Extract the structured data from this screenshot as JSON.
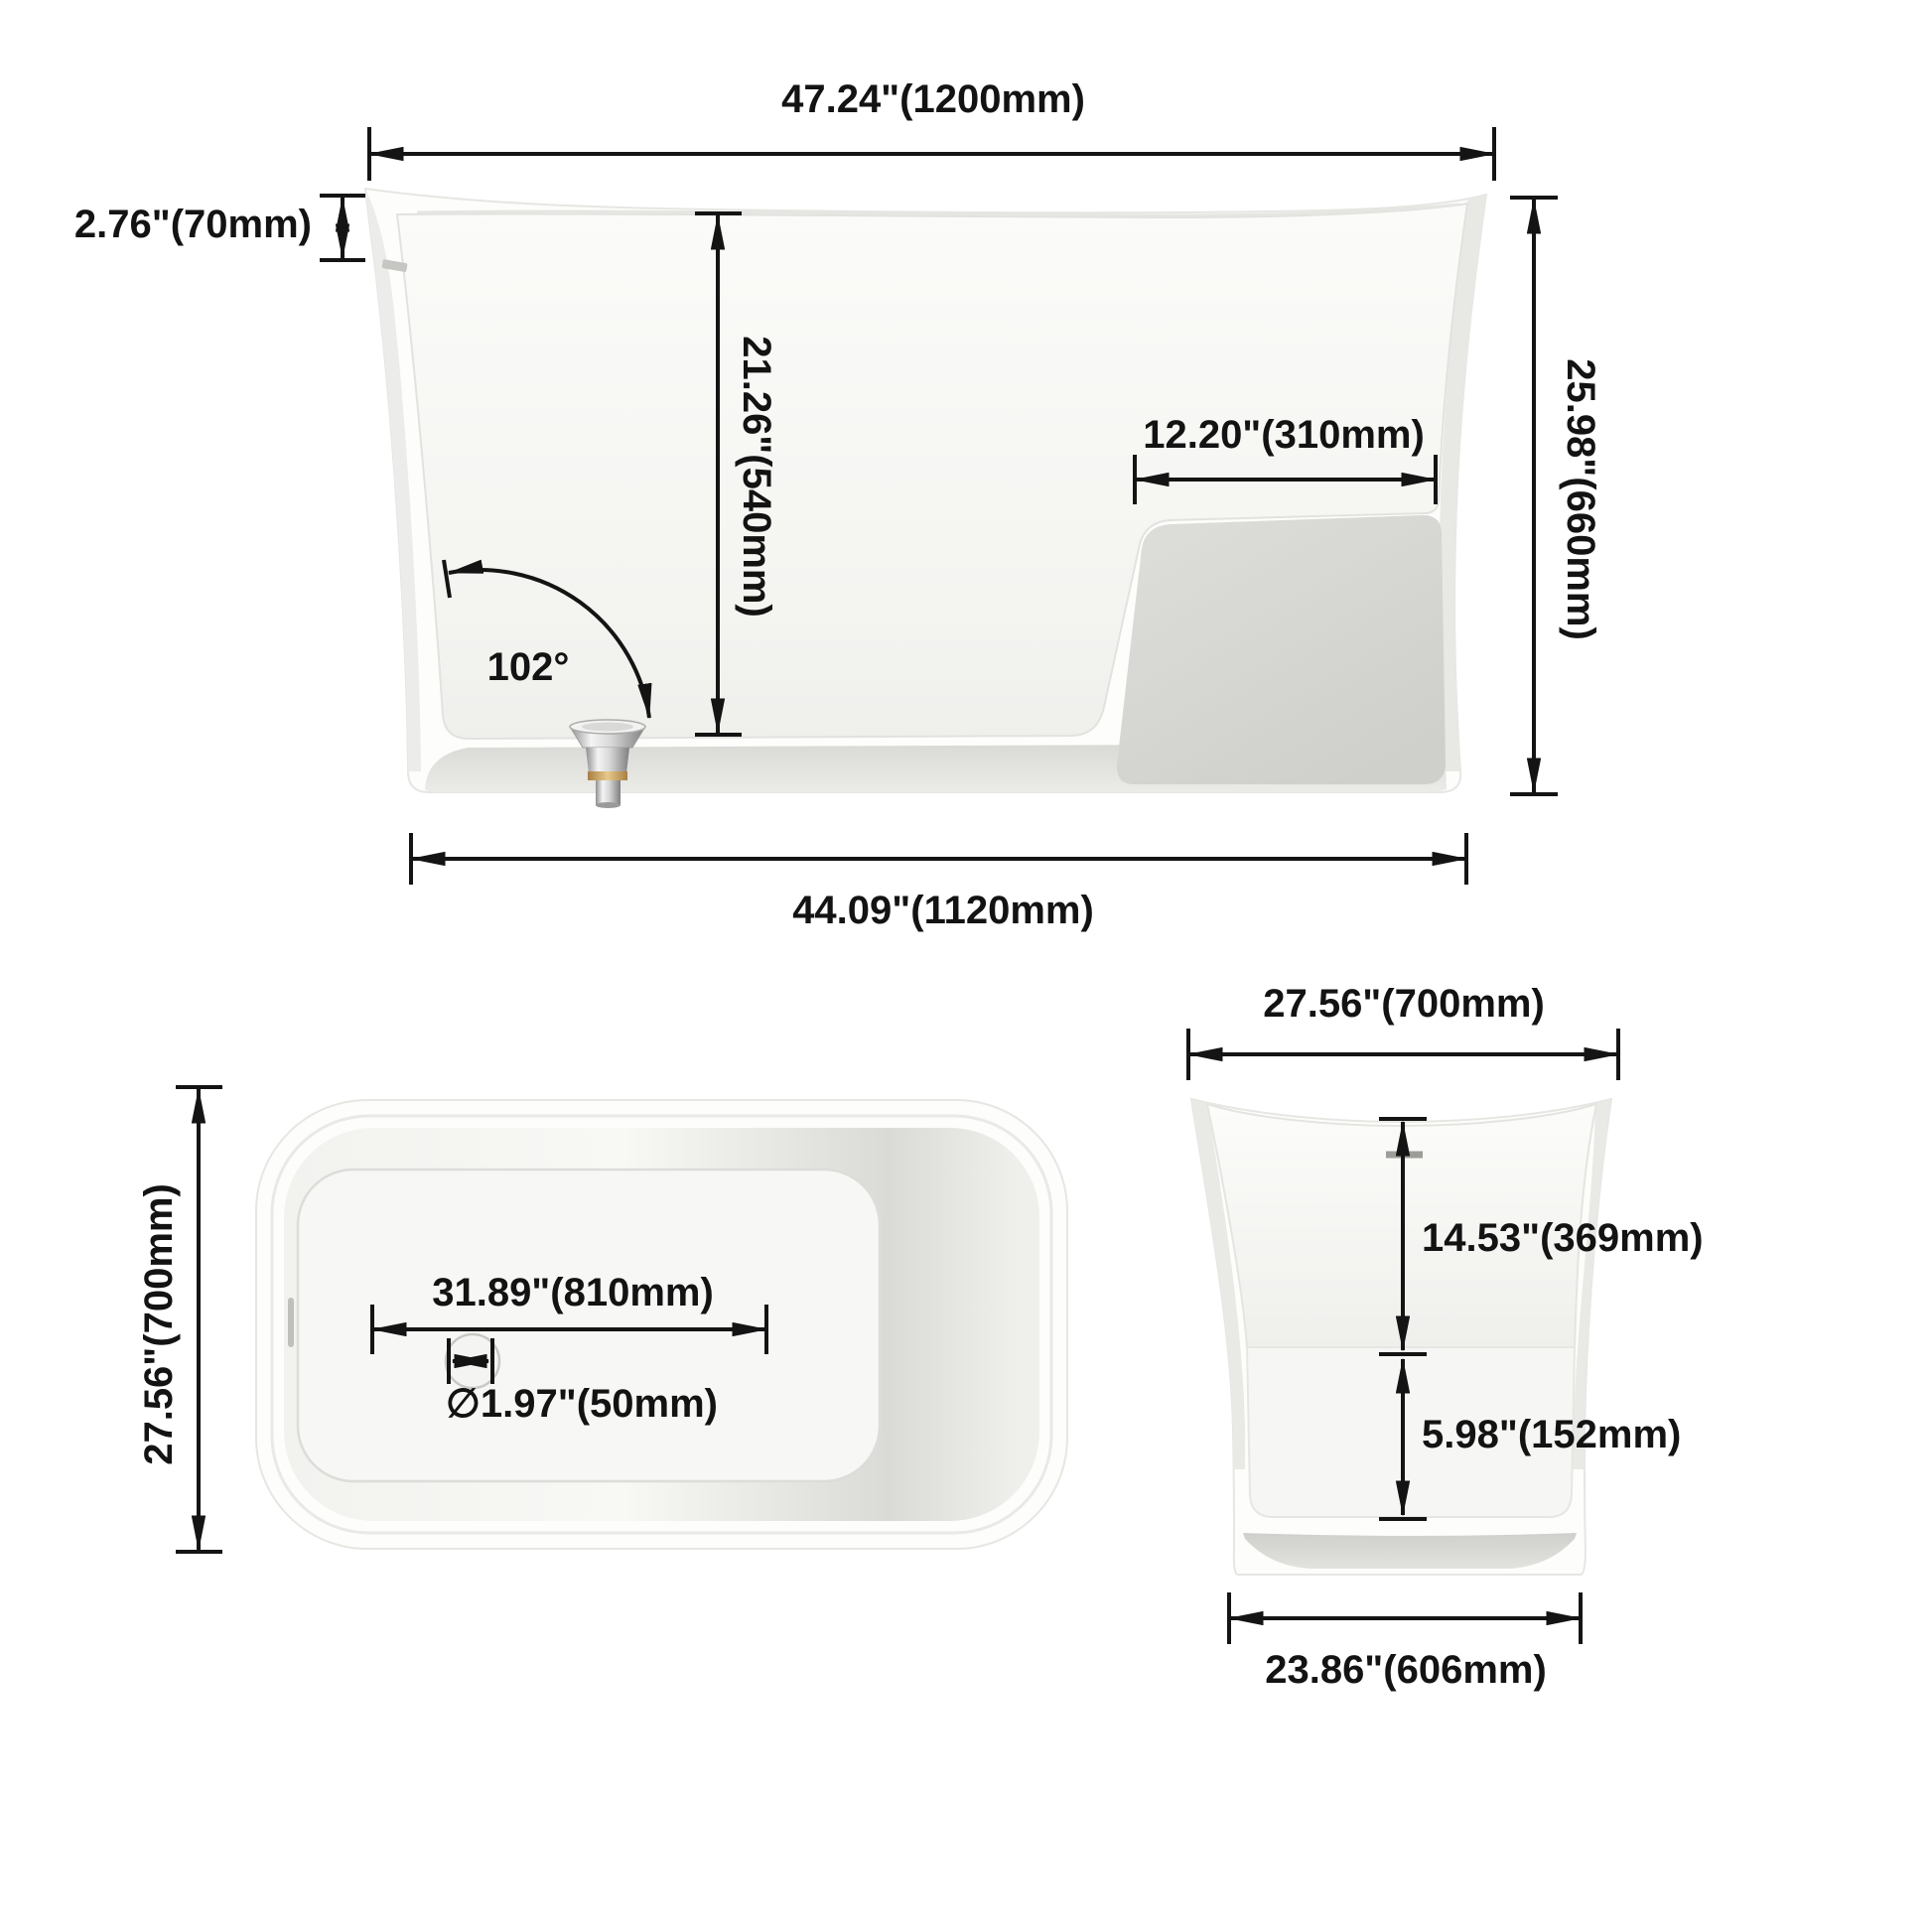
{
  "page": {
    "title": "Freestanding bathtub dimension drawing",
    "background": "#ffffff",
    "line_color": "#141414"
  },
  "style": {
    "tub_white": "#fdfdfc",
    "wall_shade": "#e9e9e6",
    "basin_shade": "#f5f5f2",
    "seat_panel_shade": "#d8d8d4",
    "chrome": "#c9c9c9",
    "brass": "#c9a15c"
  },
  "views": {
    "side": {
      "name": "side-section-view",
      "labels": {
        "overall_length": "47.24\"(1200mm)",
        "rim_drop": "2.76\"(70mm)",
        "interior_depth": "21.26\"(540mm)",
        "seat_length": "12.20\"(310mm)",
        "wall_angle": "102°",
        "overall_height": "25.98\"(660mm)",
        "base_length": "44.09\"(1120mm)"
      }
    },
    "top": {
      "name": "top-plan-view",
      "labels": {
        "overall_width": "27.56\"(700mm)",
        "floor_length": "31.89\"(810mm)",
        "drain_diameter": "∅1.97\"(50mm)"
      }
    },
    "end": {
      "name": "end-elevation-view",
      "labels": {
        "overall_width": "27.56\"(700mm)",
        "rim_to_seat_depth": "14.53\"(369mm)",
        "seat_to_floor_height": "5.98\"(152mm)",
        "base_width": "23.86\"(606mm)"
      }
    }
  }
}
